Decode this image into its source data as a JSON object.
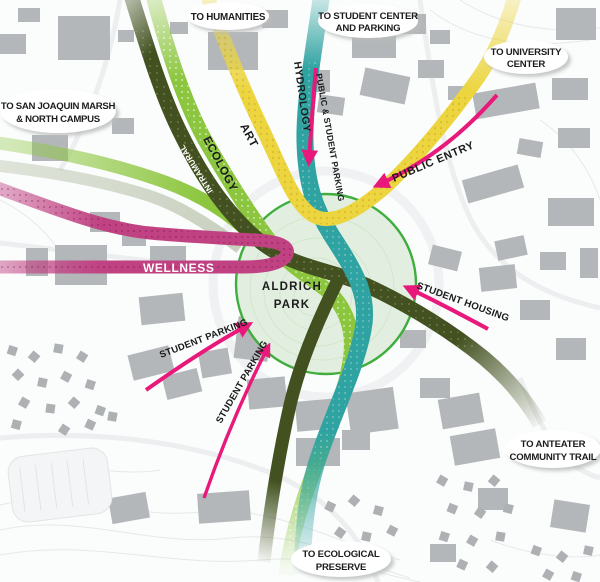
{
  "park": {
    "line1": "ALDRICH",
    "line2": "PARK"
  },
  "callouts": {
    "humanities": {
      "lines": [
        "TO HUMANITIES"
      ]
    },
    "student_center": {
      "lines": [
        "TO STUDENT CENTER",
        "AND PARKING"
      ]
    },
    "university_center": {
      "lines": [
        "TO UNIVERSITY",
        "CENTER"
      ]
    },
    "san_joaquin": {
      "lines": [
        "TO SAN JOAQUIN MARSH",
        "& NORTH CAMPUS"
      ]
    },
    "anteater": {
      "lines": [
        "TO ANTEATER",
        "COMMUNITY TRAIL"
      ]
    },
    "ecological": {
      "lines": [
        "TO ECOLOGICAL",
        "PRESERVE"
      ]
    }
  },
  "paths": {
    "hydrology": {
      "label": "HYDROLOGY",
      "color": "#2fa3a1"
    },
    "art": {
      "label": "ART",
      "color": "#ecd53e"
    },
    "ecology": {
      "label": "ECOLOGY",
      "color": "#8cc63e"
    },
    "intramural": {
      "label": "INTRAMURAL",
      "color": "#42511f"
    },
    "wellness": {
      "label": "WELLNESS",
      "color": "#c04283"
    }
  },
  "annotations": {
    "public_entry": {
      "label": "PUBLIC ENTRY"
    },
    "public_student_parking": {
      "label": "PUBLIC & STUDENT PARKING"
    },
    "student_housing": {
      "label": "STUDENT HOUSING"
    },
    "student_parking_1": {
      "label": "STUDENT PARKING"
    },
    "student_parking_2": {
      "label": "STUDENT PARKING"
    }
  },
  "colors": {
    "arrow": "#e8197a",
    "park_fill": "#e2efe0",
    "park_outline": "#3fae3d",
    "building": "#b4b7b9",
    "contour": "#e7e8e9"
  }
}
